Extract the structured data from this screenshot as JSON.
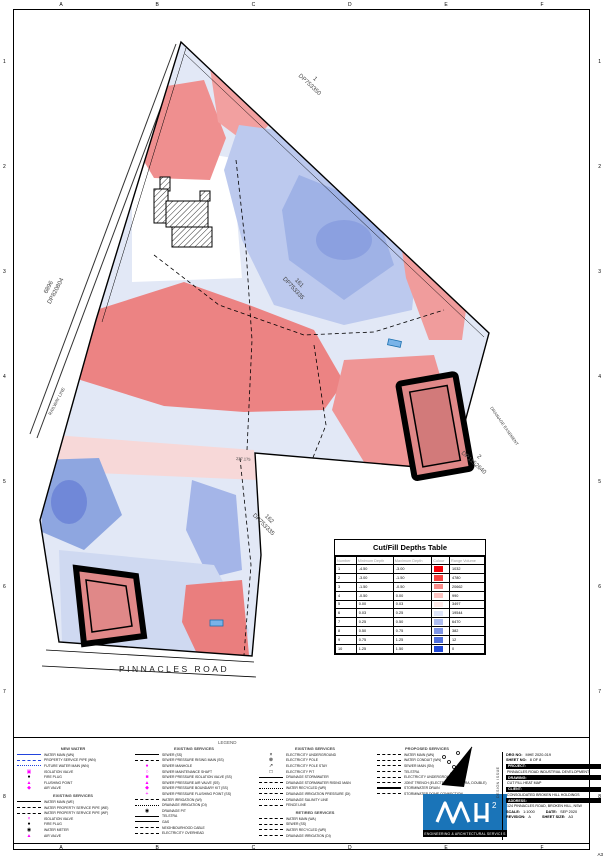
{
  "sheet": {
    "grid_letters": [
      "A",
      "B",
      "C",
      "D",
      "E",
      "F"
    ],
    "grid_numbers": [
      "1",
      "2",
      "3",
      "4",
      "5",
      "6",
      "7",
      "8"
    ],
    "corner_label": "A3"
  },
  "map": {
    "parcels": [
      {
        "lot": "1",
        "dp": "DP753350"
      },
      {
        "lot": "6896",
        "dp": "DP820804"
      },
      {
        "lot": "161",
        "dp": "DP753335"
      },
      {
        "lot": "2",
        "dp": "DP1152640"
      },
      {
        "lot": "162",
        "dp": "DP753335"
      }
    ],
    "road": "PINNACLES    ROAD",
    "railway": "RAILWAY LINE",
    "easement": "DRAINAGE EASEMENT",
    "dimension": "227.175"
  },
  "cut_fill_table": {
    "title": "Cut/Fill Depths Table",
    "columns": [
      "Number",
      "Minimum Depth",
      "Maximum Depth",
      "Colour",
      "Range Volume"
    ],
    "rows": [
      {
        "number": "1",
        "min": "-4.50",
        "max": "-3.00",
        "color": "#f50008",
        "volume": "1032"
      },
      {
        "number": "2",
        "min": "-3.00",
        "max": "-1.50",
        "color": "#f84340",
        "volume": "4780"
      },
      {
        "number": "3",
        "min": "-1.50",
        "max": "-0.50",
        "color": "#fa8a88",
        "volume": "20662"
      },
      {
        "number": "4",
        "min": "-0.50",
        "max": "0.00",
        "color": "#fcc4c2",
        "volume": "990"
      },
      {
        "number": "5",
        "min": "0.00",
        "max": "0.03",
        "color": "#fde9e8",
        "volume": "3497"
      },
      {
        "number": "6",
        "min": "0.03",
        "max": "0.25",
        "color": "#dde4f8",
        "volume": "19544"
      },
      {
        "number": "7",
        "min": "0.25",
        "max": "0.50",
        "color": "#aebdf0",
        "volume": "6470"
      },
      {
        "number": "8",
        "min": "0.50",
        "max": "0.75",
        "color": "#7f96e8",
        "volume": "382"
      },
      {
        "number": "9",
        "min": "0.75",
        "max": "1.25",
        "color": "#5070e0",
        "volume": "12"
      },
      {
        "number": "10",
        "min": "1.25",
        "max": "1.50",
        "color": "#2149d8",
        "volume": "0"
      }
    ]
  },
  "legend": {
    "title": "LEGEND",
    "columns": [
      {
        "sections": [
          {
            "title": "NEW WATER",
            "items": [
              {
                "sw": {
                  "t": "solid",
                  "c": "#2244dd"
                },
                "label": "WATER MAIN (WN)"
              },
              {
                "sw": {
                  "t": "dash",
                  "c": "#2244dd"
                },
                "label": "PROPERTY SERVICE PIPE (WN)"
              },
              {
                "sw": {
                  "t": "dashdot",
                  "c": "#2244dd"
                },
                "label": "FUTURE WATER MAIN (WN)"
              },
              {
                "sw": {
                  "t": "sym",
                  "c": "#ff00ff",
                  "g": "▣"
                },
                "label": "ISOLATION VALVE"
              },
              {
                "sw": {
                  "t": "sym",
                  "c": "#000000",
                  "g": "●"
                },
                "label": "FIRE PLUG"
              },
              {
                "sw": {
                  "t": "sym",
                  "c": "#ff00ff",
                  "g": "▲"
                },
                "label": "FLUSHING POINT"
              },
              {
                "sw": {
                  "t": "sym",
                  "c": "#ff00ff",
                  "g": "◆"
                },
                "label": "AIR VALVE"
              }
            ]
          },
          {
            "title": "EXISTING SERVICES",
            "items": [
              {
                "sw": {
                  "t": "solid",
                  "c": "#000000"
                },
                "label": "WATER MAIN (WE)"
              },
              {
                "sw": {
                  "t": "dash",
                  "c": "#000000"
                },
                "label": "WATER PROPERTY SERVICE PIPE (WE)"
              },
              {
                "sw": {
                  "t": "dash",
                  "c": "#000000"
                },
                "label": "WATER PROPERTY SERVICE PIPE (WF)"
              },
              {
                "sw": {
                  "t": "sym",
                  "c": "#ff00ff",
                  "g": "×"
                },
                "label": "ISOLATION VALVE"
              },
              {
                "sw": {
                  "t": "sym",
                  "c": "#000000",
                  "g": "●"
                },
                "label": "FIRE PLUG"
              },
              {
                "sw": {
                  "t": "sym",
                  "c": "#000000",
                  "g": "◉"
                },
                "label": "WATER METER"
              },
              {
                "sw": {
                  "t": "sym",
                  "c": "#ff00ff",
                  "g": "▲"
                },
                "label": "AIR VALVE"
              }
            ]
          }
        ]
      },
      {
        "sections": [
          {
            "title": "EXISTING SERVICES",
            "items": [
              {
                "sw": {
                  "t": "solid",
                  "c": "#000000"
                },
                "label": "SEWER (SS)"
              },
              {
                "sw": {
                  "t": "dash",
                  "c": "#000000"
                },
                "label": "SEWER PRESSURE RISING MAIN (SS)"
              },
              {
                "sw": {
                  "t": "sym",
                  "c": "#ff00ff",
                  "g": "●"
                },
                "label": "SEWER MANHOLE"
              },
              {
                "sw": {
                  "t": "sym",
                  "c": "#ff00ff",
                  "g": "○"
                },
                "label": "SEWER MAINTENANCE SHAFT"
              },
              {
                "sw": {
                  "t": "sym",
                  "c": "#ff00ff",
                  "g": "■"
                },
                "label": "SEWER PRESSURE ISOLATION VALVE (SS)"
              },
              {
                "sw": {
                  "t": "sym",
                  "c": "#ff00ff",
                  "g": "▲"
                },
                "label": "SEWER PRESSURE AIR VALVE (SS)"
              },
              {
                "sw": {
                  "t": "sym",
                  "c": "#ff00ff",
                  "g": "◆"
                },
                "label": "SEWER PRESSURE BOUNDARY KIT (SS)"
              },
              {
                "sw": {
                  "t": "sym",
                  "c": "#ff00ff",
                  "g": "+"
                },
                "label": "SEWER PRESSURE FLUSHING POINT (SS)"
              },
              {
                "sw": {
                  "t": "dash",
                  "c": "#000000"
                },
                "label": "WATER IRRIGATION (WI)"
              },
              {
                "sw": {
                  "t": "dashdot",
                  "c": "#000000"
                },
                "label": "DRAINAGE IRRIGATION (DI)"
              },
              {
                "sw": {
                  "t": "sym",
                  "c": "#000000",
                  "g": "◉"
                },
                "label": "DRAINAGE PIT"
              },
              {
                "sw": {
                  "t": "solid",
                  "c": "#000000"
                },
                "label": "TELSTRA"
              },
              {
                "sw": {
                  "t": "solid",
                  "c": "#000000"
                },
                "label": "GAS"
              },
              {
                "sw": {
                  "t": "dash",
                  "c": "#000000"
                },
                "label": "NEIGHBOURHOOD CABLE"
              },
              {
                "sw": {
                  "t": "dash",
                  "c": "#000000"
                },
                "label": "ELECTRICITY OVERHEAD"
              }
            ]
          }
        ]
      },
      {
        "sections": [
          {
            "title": "EXISTING SERVICES",
            "items": [
              {
                "sw": {
                  "t": "sym",
                  "c": "#000000",
                  "g": "×"
                },
                "label": "ELECTRICITY UNDERGROUND"
              },
              {
                "sw": {
                  "t": "sym",
                  "c": "#000000",
                  "g": "⊗"
                },
                "label": "ELECTRICITY POLE"
              },
              {
                "sw": {
                  "t": "sym",
                  "c": "#000000",
                  "g": "↗"
                },
                "label": "ELECTRICITY POLE STAY"
              },
              {
                "sw": {
                  "t": "sym",
                  "c": "#000000",
                  "g": "□"
                },
                "label": "ELECTRICITY PIT"
              },
              {
                "sw": {
                  "t": "solid",
                  "c": "#000000"
                },
                "label": "DRAINAGE STORMWATER"
              },
              {
                "sw": {
                  "t": "dash",
                  "c": "#000000"
                },
                "label": "DRAINAGE STORMWATER RISING MAIN"
              },
              {
                "sw": {
                  "t": "dashdot",
                  "c": "#000000"
                },
                "label": "WATER RECYCLED (WR)"
              },
              {
                "sw": {
                  "t": "dash",
                  "c": "#000000"
                },
                "label": "DRAINAGE IRRIGATION PRESSURE (DI)"
              },
              {
                "sw": {
                  "t": "dashdot",
                  "c": "#000000"
                },
                "label": "DRAINAGE SALINITY LINE"
              },
              {
                "sw": {
                  "t": "dash",
                  "c": "#000000"
                },
                "label": "FENCE LINE"
              }
            ]
          },
          {
            "title": "RETIRED SERVICES",
            "items": [
              {
                "sw": {
                  "t": "dash",
                  "c": "#000000"
                },
                "label": "WATER MAIN (WA)"
              },
              {
                "sw": {
                  "t": "dash",
                  "c": "#000000"
                },
                "label": "SEWER (SS)"
              },
              {
                "sw": {
                  "t": "dash",
                  "c": "#000000"
                },
                "label": "WATER RECYCLED (WR)"
              },
              {
                "sw": {
                  "t": "dash",
                  "c": "#000000"
                },
                "label": "DRAINAGE IRRIGATION (DI)"
              }
            ]
          }
        ]
      },
      {
        "sections": [
          {
            "title": "PROPOSED SERVICES",
            "items": [
              {
                "sw": {
                  "t": "dash",
                  "c": "#000000"
                },
                "label": "WATER MAIN (WN)"
              },
              {
                "sw": {
                  "t": "dash",
                  "c": "#000000"
                },
                "label": "WATER CONDUIT (WN)"
              },
              {
                "sw": {
                  "t": "dash",
                  "c": "#000000"
                },
                "label": "SEWER MAIN (SN)"
              },
              {
                "sw": {
                  "t": "dash",
                  "c": "#000000"
                },
                "label": "TELSTRA"
              },
              {
                "sw": {
                  "t": "dash",
                  "c": "#000000"
                },
                "label": "ELECTRICITY UNDERGROUND"
              },
              {
                "sw": {
                  "t": "dash",
                  "c": "#000000"
                },
                "label": "JOINT TRENCH (ELECTRICITY, TELSTRA, DOUBLE)"
              },
              {
                "sw": {
                  "t": "double",
                  "c": "#000000"
                },
                "label": "STORMWATER DRAIN"
              },
              {
                "sw": {
                  "t": "dash",
                  "c": "#000000"
                },
                "label": "STORMWATER DOME CONNECTION"
              }
            ]
          }
        ]
      }
    ]
  },
  "title_block": {
    "drg_no_label": "DRG NO:",
    "drg_no": "MHE 2020-019",
    "sheet_no_label": "SHEET NO:",
    "sheet_no": "8 OF 8",
    "project_label": "PROJECT:",
    "project": "PINNACLES ROAD INDUSTRIAL DEVELOPMENT",
    "drawing_label": "DRAWING:",
    "drawing": "CUT FILL HEAT MAP",
    "client_label": "CLIENT:",
    "client": "CONSOLIDATED BROKEN HILL HOLDINGS",
    "address_label": "ADDRESS:",
    "address": "124 PINNACLES ROAD, BROKEN HILL, NSW",
    "scale_label": "SCALE:",
    "scale": "1:1000",
    "date_label": "DATE:",
    "date": "SEP 2020",
    "revision_label": "REVISION:",
    "revision": "A",
    "sheet_size_label": "SHEET SIZE:",
    "sheet_size": "A3",
    "side_label": "DESIGN ISSUE"
  },
  "logo": {
    "sup": "2",
    "tagline": "ENGINEERING & ARCHITECTURAL SERVICES",
    "brand_color": "#1a74b8"
  },
  "colors": {
    "cut_strong": "#ec8383",
    "fill_strong": "#7088d8",
    "magenta_symbols": "#ff00ff",
    "new_water_blue": "#2244dd"
  }
}
